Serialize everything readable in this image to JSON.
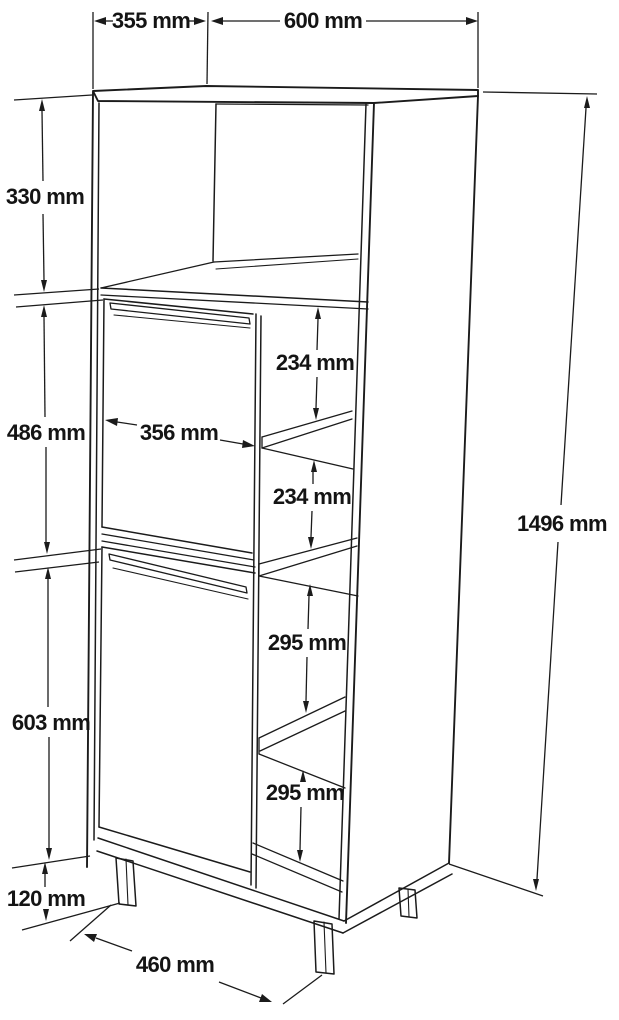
{
  "diagram": {
    "kind": "furniture-dimension-drawing",
    "subject": "tall-cabinet",
    "unit": "mm",
    "line_color": "#1b1b1b",
    "background_color": "#ffffff",
    "dimensions": {
      "d355": {
        "label": "355 mm",
        "value": 355,
        "role": "top-depth"
      },
      "d600": {
        "label": "600 mm",
        "value": 600,
        "role": "top-width"
      },
      "d330": {
        "label": "330 mm",
        "value": 330,
        "role": "upper-open-compartment-height"
      },
      "d486": {
        "label": "486 mm",
        "value": 486,
        "role": "upper-door-height"
      },
      "d356": {
        "label": "356 mm",
        "value": 356,
        "role": "door-width"
      },
      "d234a": {
        "label": "234 mm",
        "value": 234,
        "role": "upper-shelf-gap-1"
      },
      "d234b": {
        "label": "234 mm",
        "value": 234,
        "role": "upper-shelf-gap-2"
      },
      "d295a": {
        "label": "295 mm",
        "value": 295,
        "role": "lower-shelf-gap-1"
      },
      "d295b": {
        "label": "295 mm",
        "value": 295,
        "role": "lower-shelf-gap-2"
      },
      "d603": {
        "label": "603 mm",
        "value": 603,
        "role": "lower-door-height"
      },
      "d120": {
        "label": "120 mm",
        "value": 120,
        "role": "leg-height"
      },
      "d460": {
        "label": "460 mm",
        "value": 460,
        "role": "base-width"
      },
      "d1496": {
        "label": "1496 mm",
        "value": 1496,
        "role": "total-height"
      }
    }
  }
}
